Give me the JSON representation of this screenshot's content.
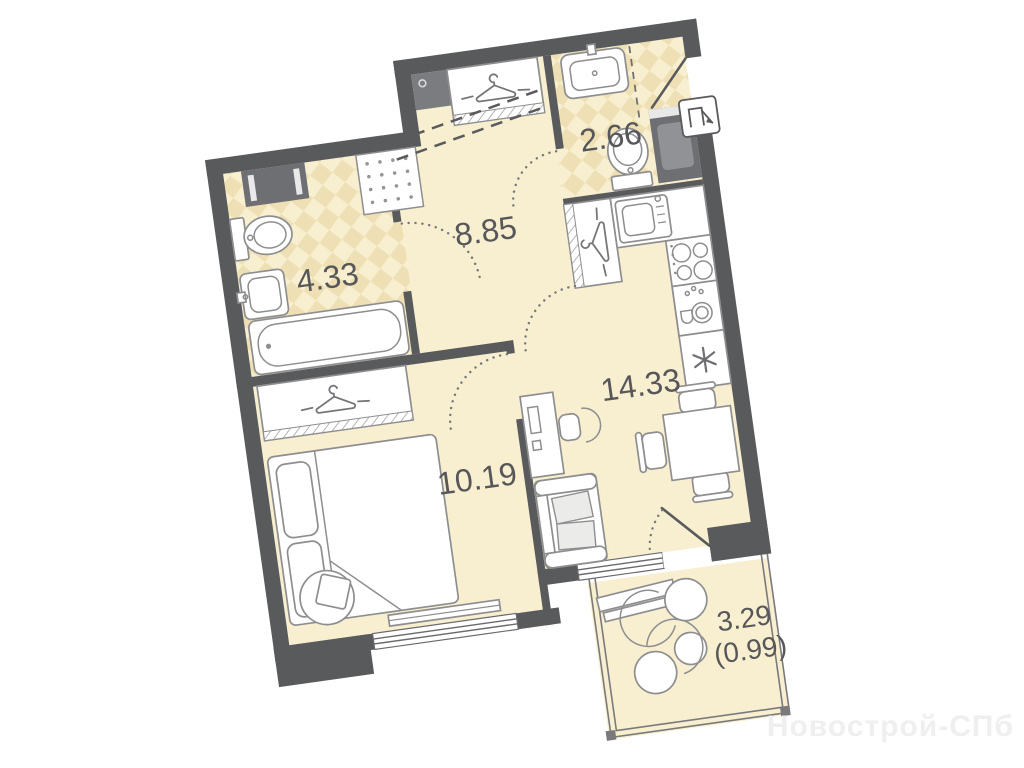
{
  "colors": {
    "wall": "#595a5c",
    "floor": "#f7efcf",
    "tile": "#eee0b4",
    "line": "#8e8e90"
  },
  "rooms": {
    "hallway": {
      "label": "8.85"
    },
    "bathroom": {
      "label": "4.33"
    },
    "wc": {
      "label": "2.66"
    },
    "kitchen_living": {
      "label": "14.33"
    },
    "bedroom": {
      "label": "10.19"
    },
    "balcony": {
      "label": "3.29",
      "label_secondary": "(0.99)"
    }
  },
  "watermark": {
    "text": "Новострой-СПб"
  }
}
